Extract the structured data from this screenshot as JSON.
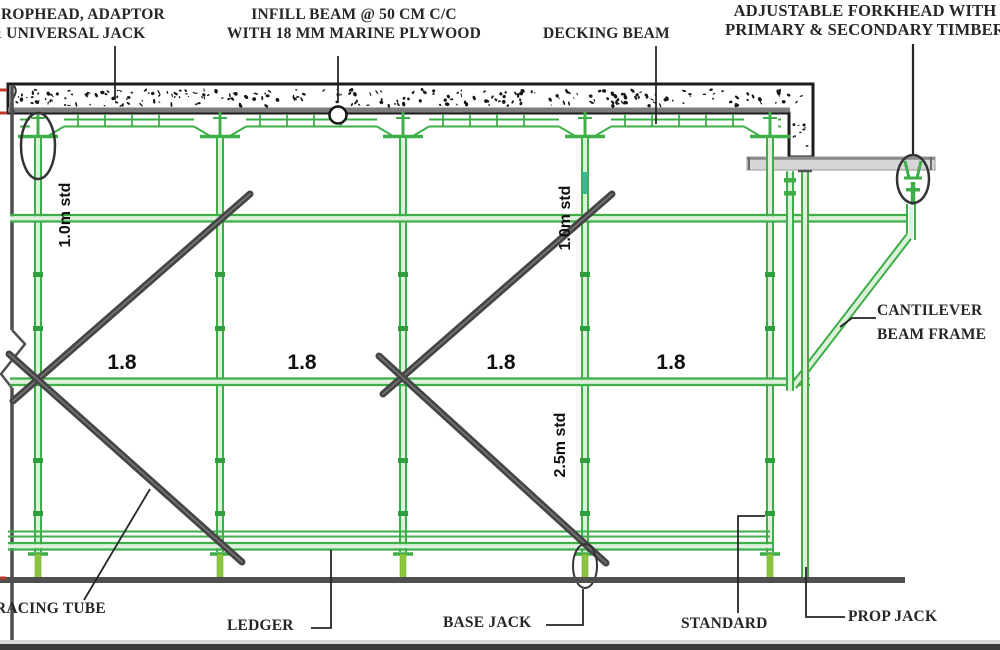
{
  "drawing_type": "scaffolding formwork section detail",
  "labels": {
    "drophead_line1": "ROPHEAD, ADAPTOR",
    "drophead_line2": "& UNIVERSAL JACK",
    "infill_line1": "INFILL BEAM @ 50 CM C/C",
    "infill_line2": "WITH 18 MM MARINE PLYWOOD",
    "decking_beam": "DECKING BEAM",
    "forkhead_line1": "ADJUSTABLE FORKHEAD WITH",
    "forkhead_line2": "PRIMARY & SECONDARY TIMBER",
    "cantilever_line1": "CANTILEVER",
    "cantilever_line2": "BEAM FRAME",
    "bracing_tube": "RACING TUBE",
    "ledger": "LEDGER",
    "base_jack": "BASE JACK",
    "standard": "STANDARD",
    "prop_jack": "PROP JACK"
  },
  "dimensions": {
    "bay_widths": [
      "1.8",
      "1.8",
      "1.8",
      "1.8"
    ],
    "standard_height_top_left": "1.0m std",
    "standard_height_top_mid": "1.0m std",
    "standard_height_bottom": "2.5m std"
  },
  "colors": {
    "green": "#3FAE49",
    "glight": "#DCF0DC",
    "gbase": "#8CC63F",
    "brace": "#454545",
    "bracehl": "#767676",
    "gray": "#4F4F4F",
    "ink": "#262626",
    "red": "#C0392B",
    "teal": "#3DB89C",
    "plank": "#D6D6D6"
  }
}
